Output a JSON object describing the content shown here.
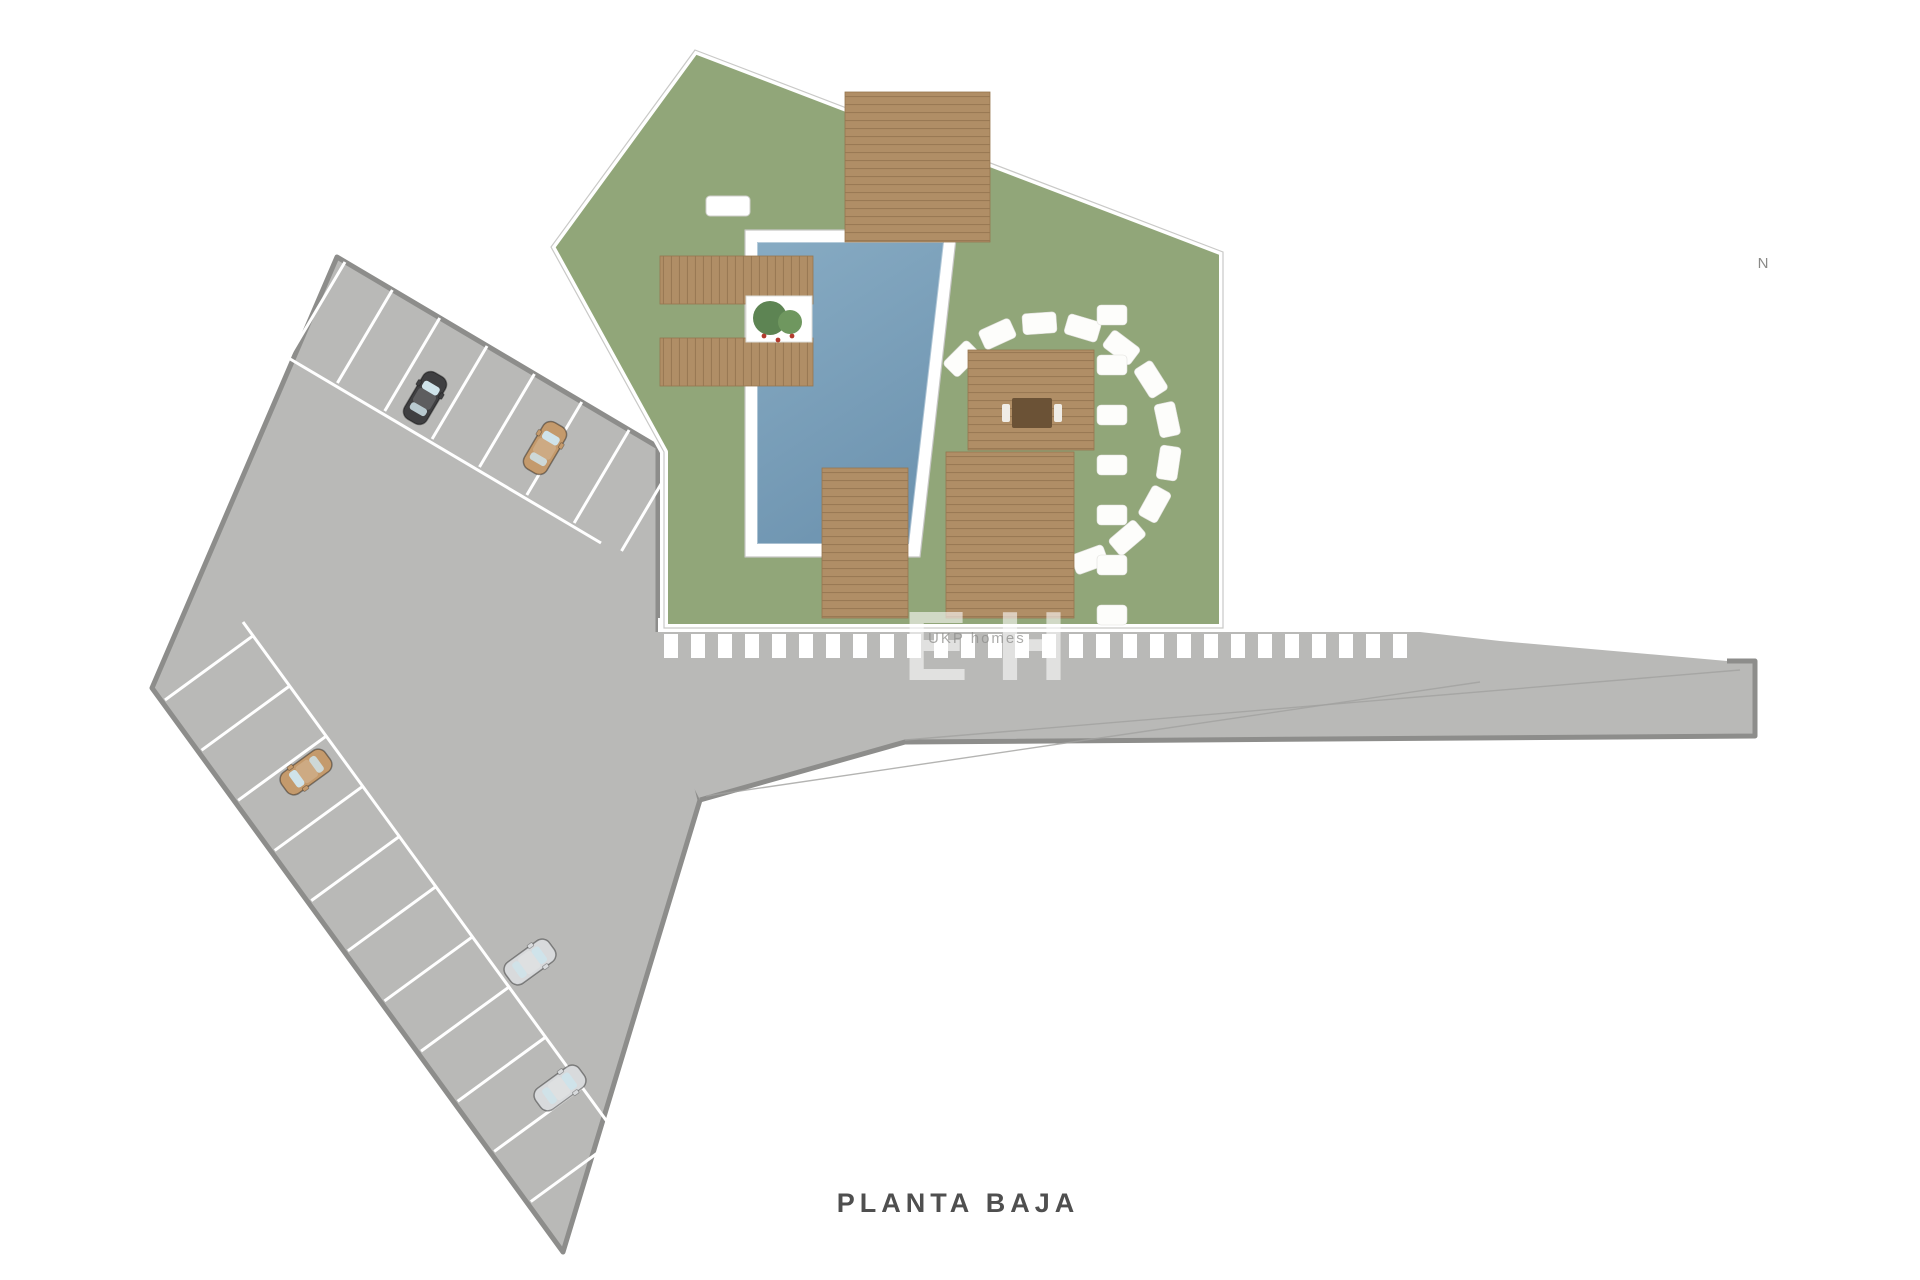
{
  "labels": {
    "plan_title": "PLANTA BAJA",
    "compass": "N"
  },
  "watermark": {
    "big": "EH",
    "small": "UKP homes"
  },
  "palette": {
    "lawn": "#91a679",
    "lawnEdge": "#c9c9c7",
    "deck": "#b08e66",
    "deckLine": "#997954",
    "deckStroke": "#96764f",
    "poolTop": "#87abc3",
    "poolBottom": "#6f95b1",
    "paving": "#b9b9b7",
    "pavingEdge": "#8d8d8b",
    "floor": "#e9e9e7",
    "wall": "#6e6e6c",
    "terrace": "#cbcbc9",
    "white": "#ffffff",
    "stone": "#fdfdfb",
    "hedge1": "#47714b",
    "hedge2": "#3a613f",
    "palm1": "#3d6a44",
    "palm2": "#4c7e52",
    "palmCore": "#2f5437",
    "bush1": "#5d8453",
    "bush2": "#6f975f",
    "tree": "#44633f",
    "gold": "#c8b184",
    "gray_text": "#8a8a88",
    "carBlack": "#3f3f41",
    "carTan": "#c49a6c",
    "carSilver": "#d8dadc",
    "cream": "#efece6",
    "bedPillow": "#c7ad85",
    "stair": "#85857f"
  },
  "parking": {
    "polygon": [
      [
        337,
        257
      ],
      [
        658,
        447
      ],
      [
        658,
        632
      ],
      [
        700,
        800
      ],
      [
        563,
        1252
      ],
      [
        152,
        688
      ]
    ],
    "aisles": [
      [
        [
          280,
          353
        ],
        [
          601,
          543
        ]
      ],
      [
        [
          243,
          622
        ],
        [
          654,
          1186
        ]
      ]
    ],
    "bay_rows": [
      {
        "ox": 345,
        "oy": 262,
        "dx": 0.861,
        "dy": 0.509,
        "nx": -0.509,
        "ny": 0.861,
        "count": 7,
        "spacing": 55,
        "len": 108
      },
      {
        "ox": 165,
        "oy": 700,
        "dx": 0.59,
        "dy": 0.809,
        "nx": 0.809,
        "ny": -0.59,
        "count": 10,
        "spacing": 62,
        "len": 110
      }
    ],
    "cars": [
      {
        "x": 425,
        "y": 398,
        "rot": 30.6,
        "color": "#3f3f41"
      },
      {
        "x": 545,
        "y": 448,
        "rot": 30.6,
        "color": "#c49a6c"
      },
      {
        "x": 306,
        "y": 772,
        "rot": -126,
        "color": "#c49a6c"
      },
      {
        "x": 530,
        "y": 962,
        "rot": 54,
        "color": "#d8dadc"
      },
      {
        "x": 560,
        "y": 1088,
        "rot": 54,
        "color": "#d8dadc"
      }
    ]
  },
  "street": {
    "polygon": [
      [
        650,
        632
      ],
      [
        1420,
        632
      ],
      [
        1500,
        641
      ],
      [
        1727,
        661
      ],
      [
        1755,
        661
      ],
      [
        1755,
        736
      ],
      [
        905,
        742
      ],
      [
        700,
        800
      ],
      [
        650,
        700
      ]
    ],
    "edge_line": [
      [
        1727,
        661
      ],
      [
        1755,
        661
      ],
      [
        1755,
        736
      ],
      [
        905,
        742
      ],
      [
        700,
        800
      ]
    ],
    "zebra": {
      "x0": 664,
      "x1": 1416,
      "y": 634,
      "h": 24,
      "w": 14,
      "step": 27
    },
    "sidewalk": [
      658,
      618,
      565,
      14
    ],
    "lane_lines": [
      [
        [
          905,
          740
        ],
        [
          1740,
          670
        ]
      ],
      [
        [
          706,
          796
        ],
        [
          1480,
          682
        ]
      ]
    ],
    "arrows": [
      {
        "x": 1737,
        "y": 618
      },
      {
        "x": 1737,
        "y": 690
      }
    ]
  },
  "garden": {
    "polygon": [
      [
        695,
        50
      ],
      [
        1223,
        252
      ],
      [
        1223,
        628
      ],
      [
        664,
        628
      ],
      [
        664,
        452
      ],
      [
        551,
        247
      ]
    ],
    "pool": {
      "outer": [
        [
          745,
          230
        ],
        [
          957,
          230
        ],
        [
          920,
          557
        ],
        [
          745,
          557
        ]
      ],
      "water": [
        [
          757,
          242
        ],
        [
          944,
          242
        ],
        [
          909,
          544
        ],
        [
          757,
          544
        ]
      ]
    },
    "decks": [
      {
        "x": 845,
        "y": 92,
        "w": 145,
        "h": 150,
        "dir": "h"
      },
      {
        "x": 660,
        "y": 256,
        "w": 153,
        "h": 48,
        "dir": "v"
      },
      {
        "x": 660,
        "y": 338,
        "w": 153,
        "h": 48,
        "dir": "v"
      },
      {
        "x": 822,
        "y": 468,
        "w": 86,
        "h": 150,
        "dir": "h"
      },
      {
        "x": 968,
        "y": 350,
        "w": 126,
        "h": 100,
        "dir": "h"
      },
      {
        "x": 946,
        "y": 452,
        "w": 128,
        "h": 166,
        "dir": "h"
      }
    ],
    "pavilion_table": [
      1012,
      398,
      40,
      30
    ],
    "planter": {
      "x": 746,
      "y": 296,
      "w": 66,
      "h": 46
    },
    "loungers": [
      {
        "x": 706,
        "y": 196,
        "w": 44,
        "h": 20
      },
      {
        "x": 706,
        "y": 244,
        "w": 44,
        "h": 20
      },
      {
        "x": 766,
        "y": 148,
        "w": 20,
        "h": 42
      },
      {
        "x": 791,
        "y": 148,
        "w": 20,
        "h": 42
      },
      {
        "x": 762,
        "y": 486,
        "w": 21,
        "h": 38
      },
      {
        "x": 788,
        "y": 486,
        "w": 21,
        "h": 38
      },
      {
        "x": 698,
        "y": 438,
        "w": 32,
        "h": 42
      }
    ],
    "parasols": [
      {
        "x": 817,
        "y": 170,
        "r": 20
      },
      {
        "x": 791,
        "y": 527,
        "r": 19
      }
    ],
    "picnic_tables": [
      {
        "x": 998,
        "y": 255,
        "w": 40,
        "h": 52,
        "rot": -28
      },
      {
        "x": 1075,
        "y": 281,
        "w": 38,
        "h": 50,
        "rot": -28
      }
    ],
    "stone_arc": {
      "cx": 1048,
      "cy": 445,
      "r": 122,
      "a0": -135,
      "a1": 111,
      "count": 13,
      "w": 34,
      "h": 21
    },
    "path_stones": {
      "x": 1112,
      "y0": 305,
      "step": 50,
      "count": 7,
      "w": 30,
      "h": 20
    },
    "hedge": {
      "x": 1190,
      "y0": 268,
      "y1": 612,
      "step": 26
    },
    "palms": [
      {
        "x": 737,
        "y": 118,
        "s": 1.1
      },
      {
        "x": 808,
        "y": 105,
        "s": 0.85
      },
      {
        "x": 1110,
        "y": 282,
        "s": 1.25
      },
      {
        "x": 672,
        "y": 445,
        "s": 0.95
      },
      {
        "x": 950,
        "y": 590,
        "s": 0.9
      }
    ],
    "trees": [
      [
        1197,
        248,
        26
      ],
      [
        1165,
        232,
        20
      ],
      [
        700,
        88,
        17
      ]
    ],
    "bushes": [
      [
        667,
        140,
        16
      ],
      [
        640,
        225,
        14
      ],
      [
        600,
        300,
        16
      ],
      [
        615,
        385,
        13
      ],
      [
        680,
        527,
        15
      ],
      [
        762,
        75,
        13
      ],
      [
        905,
        152,
        14
      ],
      [
        1010,
        196,
        13
      ],
      [
        700,
        608,
        12
      ],
      [
        862,
        612,
        13
      ],
      [
        1160,
        250,
        18
      ],
      [
        1135,
        205,
        12
      ],
      [
        725,
        70,
        11
      ]
    ]
  },
  "forecourt": {
    "polygon": [
      [
        1148,
        212
      ],
      [
        1223,
        250
      ],
      [
        1223,
        628
      ],
      [
        1160,
        628
      ]
    ],
    "tables": [
      {
        "x": 1193,
        "y": 300,
        "r": 14
      },
      {
        "x": 1182,
        "y": 478,
        "r": 12
      }
    ]
  },
  "building": {
    "outline": [
      [
        1223,
        252
      ],
      [
        1727,
        368
      ],
      [
        1727,
        660
      ],
      [
        1223,
        628
      ]
    ],
    "terrace": [
      [
        1337,
        284
      ],
      [
        1443,
        314
      ],
      [
        1443,
        402
      ],
      [
        1337,
        396
      ]
    ],
    "terrace_tables": [
      {
        "x": 1368,
        "y": 348,
        "r": 13
      },
      {
        "x": 1420,
        "y": 362,
        "r": 12
      }
    ],
    "terrace_plants": [
      [
        1350,
        295,
        10
      ],
      [
        1437,
        320,
        9
      ]
    ],
    "walls": [
      [
        [
          1316,
          262
        ],
        [
          1316,
          470
        ]
      ],
      [
        [
          1316,
          508
        ],
        [
          1316,
          628
        ]
      ],
      [
        [
          1445,
          310
        ],
        [
          1445,
          440
        ]
      ],
      [
        [
          1445,
          470
        ],
        [
          1445,
          628
        ]
      ],
      [
        [
          1555,
          352
        ],
        [
          1555,
          470
        ]
      ],
      [
        [
          1555,
          505
        ],
        [
          1555,
          658
        ]
      ],
      [
        [
          1223,
          487
        ],
        [
          1300,
          487
        ]
      ],
      [
        [
          1316,
          520
        ],
        [
          1394,
          520
        ]
      ],
      [
        [
          1390,
          482
        ],
        [
          1445,
          482
        ]
      ],
      [
        [
          1390,
          482
        ],
        [
          1390,
          540
        ]
      ],
      [
        [
          1555,
          537
        ],
        [
          1640,
          537
        ]
      ],
      [
        [
          1668,
          539
        ],
        [
          1727,
          545
        ]
      ],
      [
        [
          1640,
          372
        ],
        [
          1640,
          430
        ]
      ],
      [
        [
          1683,
          390
        ],
        [
          1683,
          440
        ]
      ]
    ],
    "windows": [
      [
        [
          1255,
          259
        ],
        [
          1300,
          270
        ]
      ],
      [
        [
          1360,
          284
        ],
        [
          1405,
          294
        ]
      ],
      [
        [
          1475,
          310
        ],
        [
          1520,
          320
        ]
      ],
      [
        [
          1590,
          336
        ],
        [
          1635,
          347
        ]
      ],
      [
        [
          1280,
          631
        ],
        [
          1330,
          634
        ]
      ],
      [
        [
          1460,
          643
        ],
        [
          1505,
          646
        ]
      ],
      [
        [
          1727,
          450
        ],
        [
          1727,
          500
        ]
      ]
    ],
    "stairs": {
      "x": 1449,
      "y": 505,
      "w": 52,
      "h": 92
    },
    "beds": [
      {
        "x": 1458,
        "y": 352,
        "w": 60,
        "h": 46
      },
      {
        "x": 1357,
        "y": 412,
        "w": 48,
        "h": 58
      },
      {
        "x": 1236,
        "y": 492,
        "w": 56,
        "h": 48
      },
      {
        "x": 1627,
        "y": 406,
        "w": 56,
        "h": 50
      },
      {
        "x": 1630,
        "y": 550,
        "w": 56,
        "h": 48
      },
      {
        "x": 1240,
        "y": 566,
        "w": 46,
        "h": 56
      }
    ],
    "dining_tables": [
      {
        "x": 1280,
        "y": 362,
        "r": 17
      },
      {
        "x": 1595,
        "y": 500,
        "r": 16
      }
    ],
    "sofa": {
      "rects": [
        [
          1230,
          268,
          78,
          24
        ],
        [
          1230,
          268,
          24,
          66
        ]
      ],
      "table": [
        1264,
        314,
        28,
        20
      ]
    },
    "sofa2": [
      1598,
      472,
      58,
      22
    ],
    "kitchens": [
      {
        "rects": [
          [
            1226,
            536,
            16,
            86
          ],
          [
            1226,
            606,
            88,
            16
          ]
        ],
        "appliance": [
          1229,
          578,
          12,
          12
        ]
      },
      {
        "rects": [
          [
            1704,
            432,
            16,
            108
          ]
        ],
        "appliance": [
          1707,
          470,
          11,
          11
        ]
      }
    ],
    "baths": [
      {
        "rect": [
          1390,
          484,
          54,
          54
        ],
        "toilet": [
          1404,
          498
        ]
      },
      {
        "rect": [
          1558,
          314,
          56,
          54
        ],
        "toilet": [
          1572,
          328
        ]
      },
      {
        "rect": [
          1648,
          562,
          66,
          50
        ],
        "toilet": [
          1662,
          576
        ]
      }
    ]
  },
  "compass": {
    "cx": 1781,
    "cy": 231,
    "r": 25,
    "needle": [
      [
        1793,
        217
      ],
      [
        1768,
        246
      ]
    ]
  }
}
